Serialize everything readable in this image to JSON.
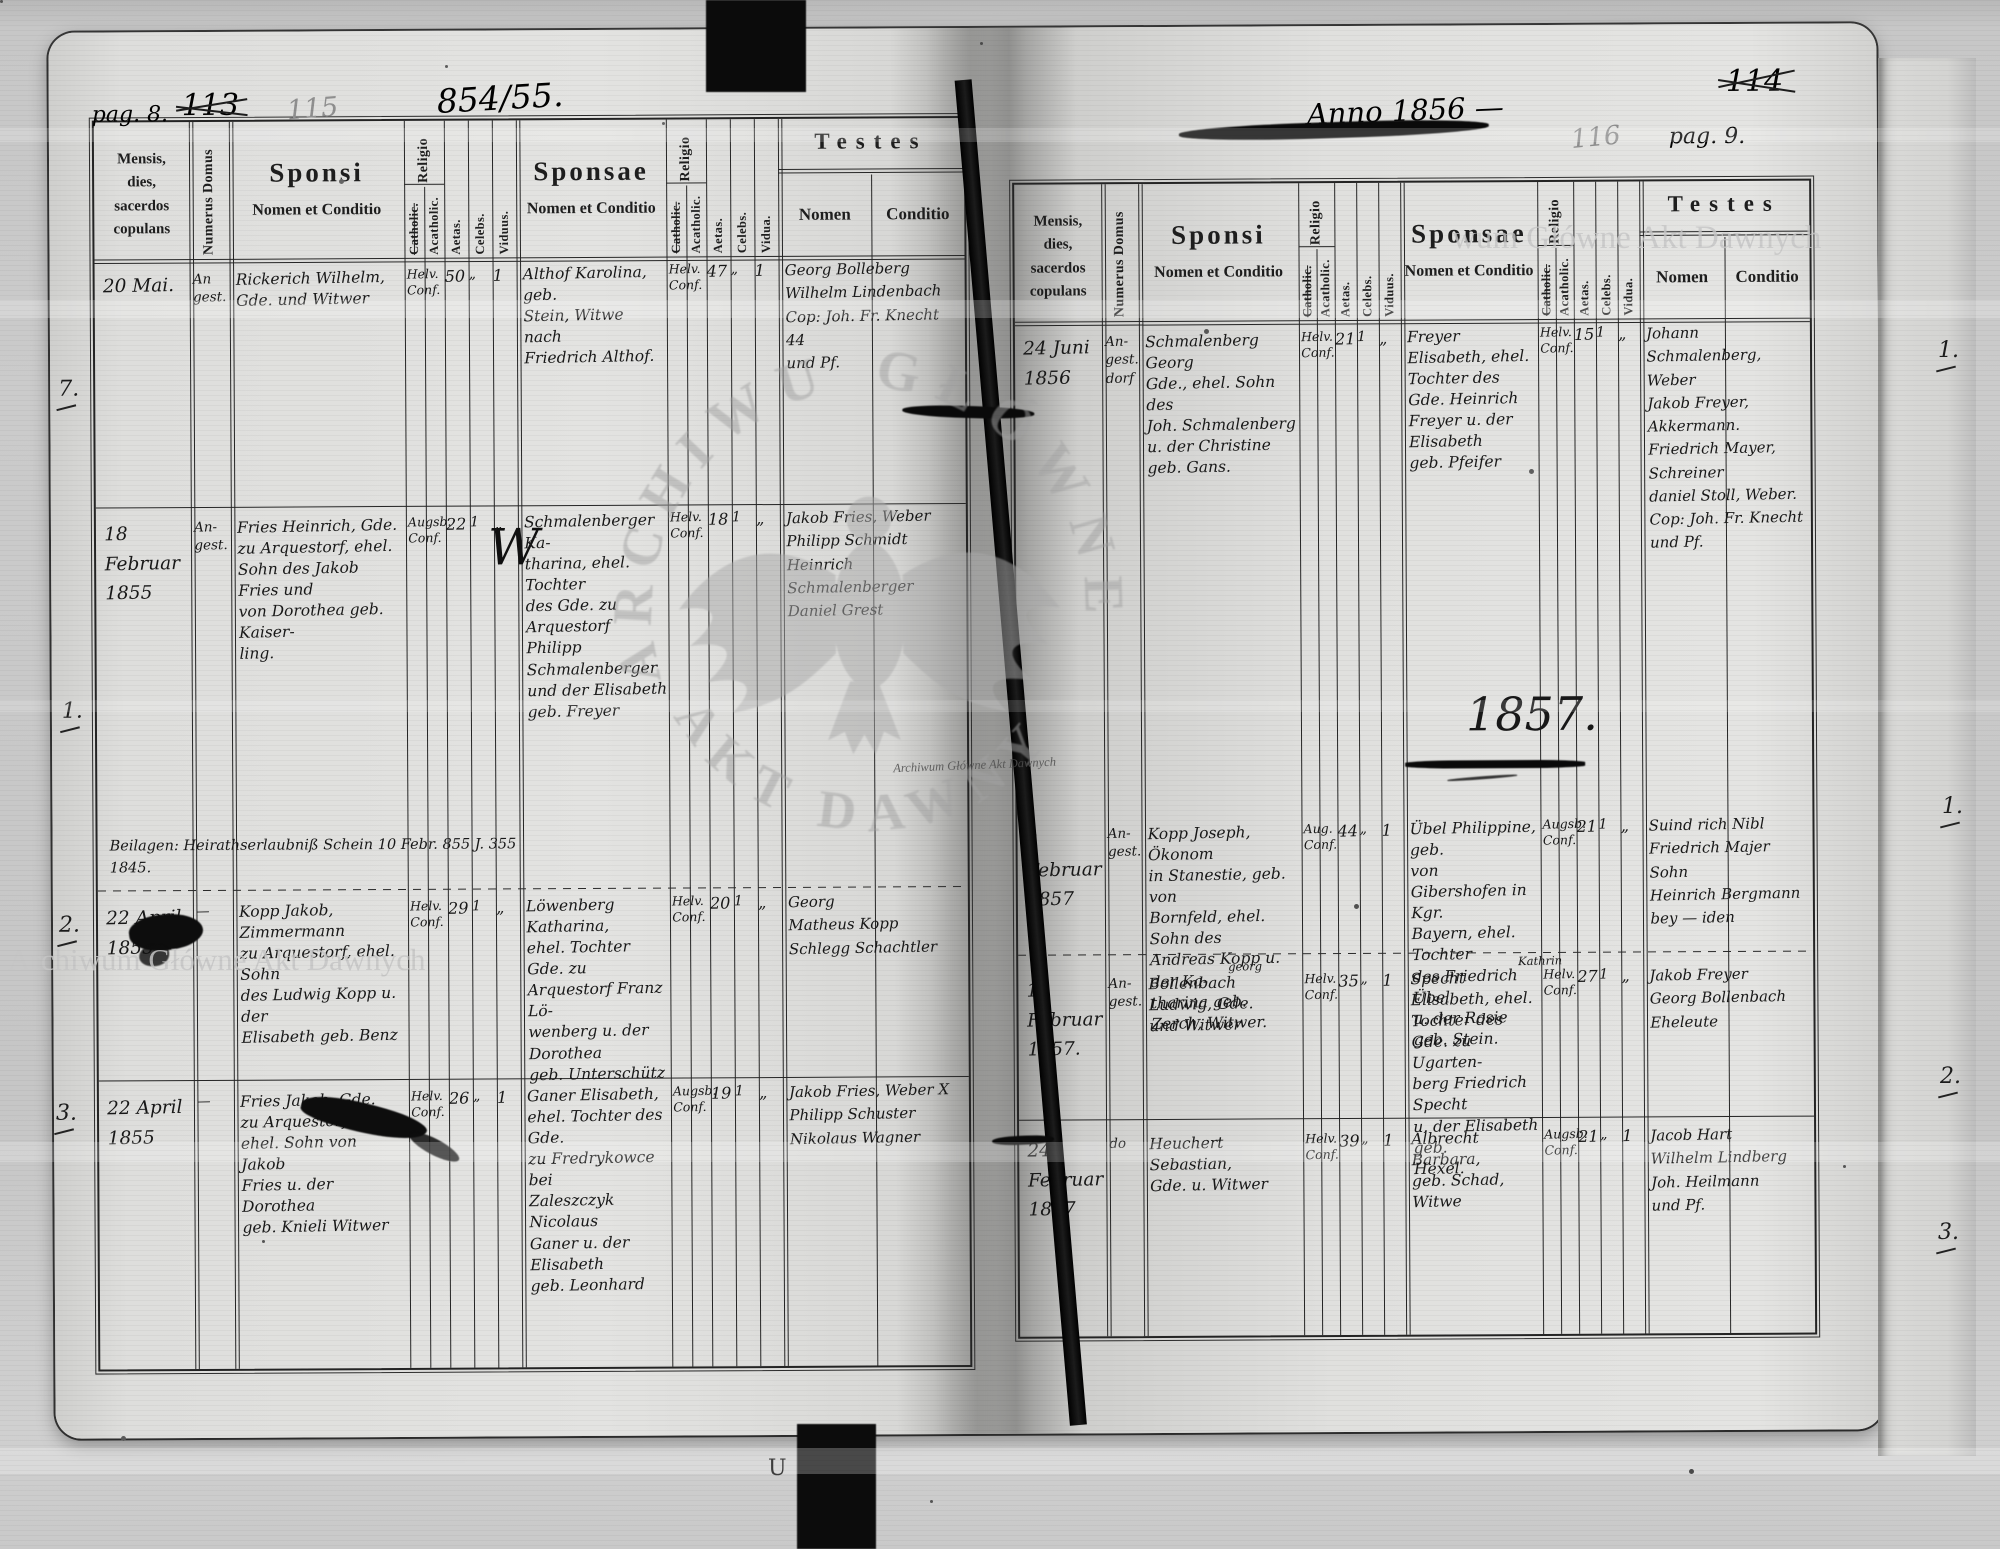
{
  "watermarks": {
    "corner_top_right": "wum Główne Akt Dawnych",
    "corner_bottom_left": "Archiwum Główne Akt Dawnych",
    "stamp_small": "Archiwum Główne Akt Dawnych",
    "eagle_arc_left": "ARCHIWUM",
    "eagle_arc_right": "GŁÓWNE",
    "eagle_arc_bottom": "AKT DAWNYCH"
  },
  "header": {
    "mensis": "Mensis,\ndies,\nsacerdos\ncopulans",
    "numerus": "Numerus Domus",
    "sponsi": "Sponsi",
    "sponsi_sub": "Nomen et Conditio",
    "sponsae": "Sponsae",
    "sponsae_sub": "Nomen et Conditio",
    "religio": "Religio",
    "catholic": "Catholic.",
    "acatholic": "Acatholic.",
    "aetas": "Aetas.",
    "celebs": "Celebs.",
    "viduus": "Viduus.",
    "vidua": "Vidua.",
    "testes": "Testes",
    "nomen": "Nomen",
    "conditio": "Conditio"
  },
  "left_page": {
    "annotations": {
      "pag": "pag. 8.",
      "old_folio": "113",
      "pencil_folio": "115",
      "ink_folio": "854/55."
    },
    "flourish": "W",
    "note": "Beilagen:  Heirathserlaubniß Schein  10 Febr. 855    J. 355\n1845.",
    "rows": [
      {
        "margin": "7.",
        "date": "20 Mai.",
        "num": "An\ngest.",
        "sponsi": "Rickerich Wilhelm,\nGde. und Witwer",
        "rel_s": "Helv.\nConf.",
        "aet_s": "50",
        "cel_s": "„",
        "vid_s": "1",
        "sponsae": "Althof Karolina, geb.\nStein, Witwe nach\nFriedrich Althof.",
        "rel_p": "Helv.\nConf.",
        "aet_p": "47",
        "cel_p": "„",
        "vid_p": "1",
        "testes": "Georg   Bolleberg\nWilhelm   Lindenbach\nCop: Joh. Fr.  Knecht 44\nund Pf."
      },
      {
        "margin": "1.",
        "date": "18 Februar\n1855",
        "num": "An-\ngest.",
        "sponsi": "Fries Heinrich, Gde.\nzu Arquestorf, ehel.\nSohn des Jakob Fries und\nvon Dorothea geb. Kaiser-\nling.",
        "rel_s": "Augsb.\nConf.",
        "aet_s": "22",
        "cel_s": "1",
        "vid_s": "„",
        "sponsae": "Schmalenberger Ka-\ntharina, ehel. Tochter\ndes Gde. zu Arquestorf\nPhilipp Schmalenberger\nund der Elisabeth\ngeb. Freyer",
        "rel_p": "Helv.\nConf.",
        "aet_p": "18",
        "cel_p": "1",
        "vid_p": "„",
        "testes": "Jakob Fries, Weber\nPhilipp   Schmidt\nHeinrich  Schmalenberger\nDaniel   Grest"
      },
      {
        "margin": "2.",
        "date": "22 April\n1855",
        "num": "—",
        "sponsi": "Kopp Jakob, Zimmermann\nzu Arquestorf, ehel. Sohn\ndes Ludwig Kopp u. der\nElisabeth geb. Benz",
        "rel_s": "Helv.\nConf.",
        "aet_s": "29",
        "cel_s": "1",
        "vid_s": "„",
        "sponsae": "Löwenberg Katharina,\nehel. Tochter Gde. zu\nArquestorf Franz Lö-\nwenberg u. der Dorothea\ngeb. Unterschütz",
        "rel_p": "Helv.\nConf.",
        "aet_p": "20",
        "cel_p": "1",
        "vid_p": "„",
        "testes": "Georg\nMatheus   Kopp\nSchlegg   Schachtler"
      },
      {
        "margin": "3.",
        "date": "22 April\n1855",
        "num": "—",
        "sponsi": "Fries Jakob, Gde.\nzu Arquestorf\nehel. Sohn von Jakob\nFries u. der Dorothea\ngeb. Knieli Witwer",
        "rel_s": "Helv.\nConf.",
        "aet_s": "26",
        "cel_s": "„",
        "vid_s": "1",
        "sponsae": "Ganer Elisabeth,\nehel. Tochter des Gde.\nzu Fredrykowce bei\nZaleszczyk Nicolaus\nGaner u. der Elisabeth\ngeb. Leonhard",
        "rel_p": "Augsb.\nConf.",
        "aet_p": "19",
        "cel_p": "1",
        "vid_p": "„",
        "testes": "Jakob Fries, Weber X\nPhilipp   Schuster\nNikolaus   Wagner"
      }
    ]
  },
  "right_page": {
    "annotations": {
      "anno": "Anno 1856 —",
      "old_folio": "114",
      "pencil_folio": "116",
      "pag": "pag. 9.",
      "year_heading": "1857."
    },
    "rows": [
      {
        "margin": "1.",
        "date": "24 Juni\n1856",
        "num": "An-\ngest.\ndorf",
        "sponsi": "Schmalenberg Georg\nGde., ehel. Sohn des\nJoh. Schmalenberg\nu. der Christine\ngeb. Gans.",
        "rel_s": "Helv.\nConf.",
        "aet_s": "21",
        "cel_s": "1",
        "vid_s": "„",
        "sponsae": "Freyer Elisabeth, ehel.\nTochter des Gde. Heinrich\nFreyer u. der Elisabeth\ngeb. Pfeifer",
        "rel_p": "Helv.\nConf.",
        "aet_p": "15",
        "cel_p": "1",
        "vid_p": "„",
        "testes": "Johann Schmalenberg, Weber\nJakob Freyer, Akkermann.\nFriedrich Mayer, Schreiner\ndaniel Stoll, Weber.\nCop: Joh. Fr. Knecht\nund Pf."
      },
      {
        "margin": "1.",
        "date": "8 Februar\n1857",
        "num": "An-\ngest.",
        "sponsi": "Kopp Joseph, Ökonom\nin Stanestie, geb. von\nBornfeld, ehel. Sohn des\nAndreas Kopp u. der Ka-\ntharina geb. Zerch, Witwer.",
        "rel_s": "Aug.\nConf.",
        "aet_s": "44",
        "cel_s": "„",
        "vid_s": "1",
        "sponsae": "Übel Philippine, geb.\nvon Gibershofen in Kgr.\nBayern, ehel. Tochter\ndes Friedrich Übel\nu. der Rosie geb. Stein.",
        "rel_p": "Augsb.\nConf.",
        "aet_p": "21",
        "cel_p": "1",
        "vid_p": "„",
        "testes": "Suind  rich Nibl\nFriedrich Majer  Sohn\nHeinrich  Bergmann\nbey — iden"
      },
      {
        "margin": "2.",
        "date": "15 Februar\n1857.",
        "num": "An-\ngest.",
        "super": "georg",
        "super2": "Kathrin",
        "sponsi": "Bollenbach Ludwig, Gde.\nund Witwer",
        "rel_s": "Helv.\nConf.",
        "aet_s": "35",
        "cel_s": "„",
        "vid_s": "1",
        "sponsae": "Specht Elisabeth, ehel.\nTochter des Gde. zu Ugarten-\nberg Friedrich Specht\nu. der Elisabeth geb.\nHexel.",
        "rel_p": "Helv.\nConf.",
        "aet_p": "27",
        "cel_p": "1",
        "vid_p": "„",
        "testes": "Jakob   Freyer\nGeorg   Bollenbach\nEheleute"
      },
      {
        "margin": "3.",
        "date": "24 Februar\n1857",
        "num": "do",
        "sponsi": "Heuchert Sebastian,\nGde. u. Witwer",
        "rel_s": "Helv.\nConf.",
        "aet_s": "39",
        "cel_s": "„",
        "vid_s": "1",
        "sponsae": "Albrecht Barbara,\ngeb. Schad, Witwe",
        "rel_p": "Augsb.\nConf.",
        "aet_p": "21",
        "cel_p": "„",
        "vid_p": "1",
        "testes": "Jacob   Hart\nWilhelm   Lindberg\nJoh. Heilmann\nund Pf."
      }
    ]
  },
  "marks": {
    "u_mark": "U"
  }
}
